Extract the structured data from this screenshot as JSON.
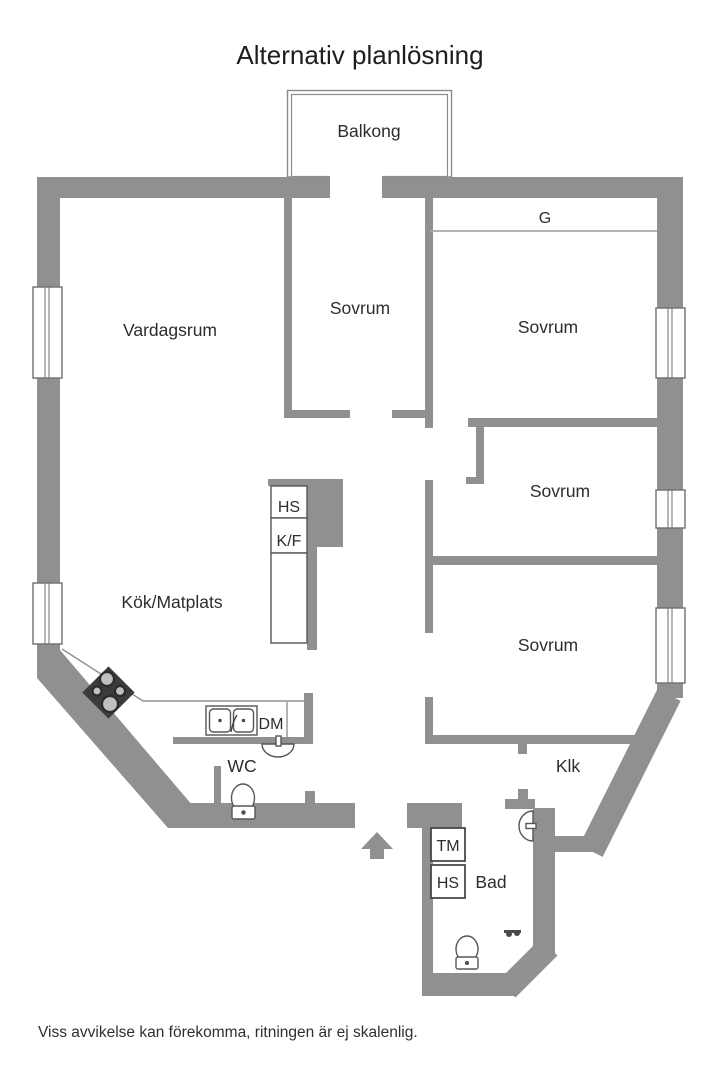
{
  "title": "Alternativ planlösning",
  "footer_note": "Viss avvikelse kan förekomma, ritningen är ej skalenlig.",
  "colors": {
    "wall": "#8e9190",
    "label_text": "#2d2d2d",
    "fixture_stroke": "#565656",
    "stove_fill": "#3b3b3b"
  },
  "labels": {
    "balcony": "Balkong",
    "living_room": "Vardagsrum",
    "bedroom_middle": "Sovrum",
    "bedroom_top_right": "Sovrum",
    "bedroom_mid_right": "Sovrum",
    "bedroom_bottom_right": "Sovrum",
    "kitchen": "Kök/Matplats",
    "wardrobe": "G",
    "tall_cabinet": "HS",
    "fridge_freezer": "K/F",
    "dishwasher": "DM",
    "wc": "WC",
    "washing_machine": "TM",
    "bath_cabinet": "HS",
    "bathroom": "Bad",
    "closet": "Klk"
  }
}
